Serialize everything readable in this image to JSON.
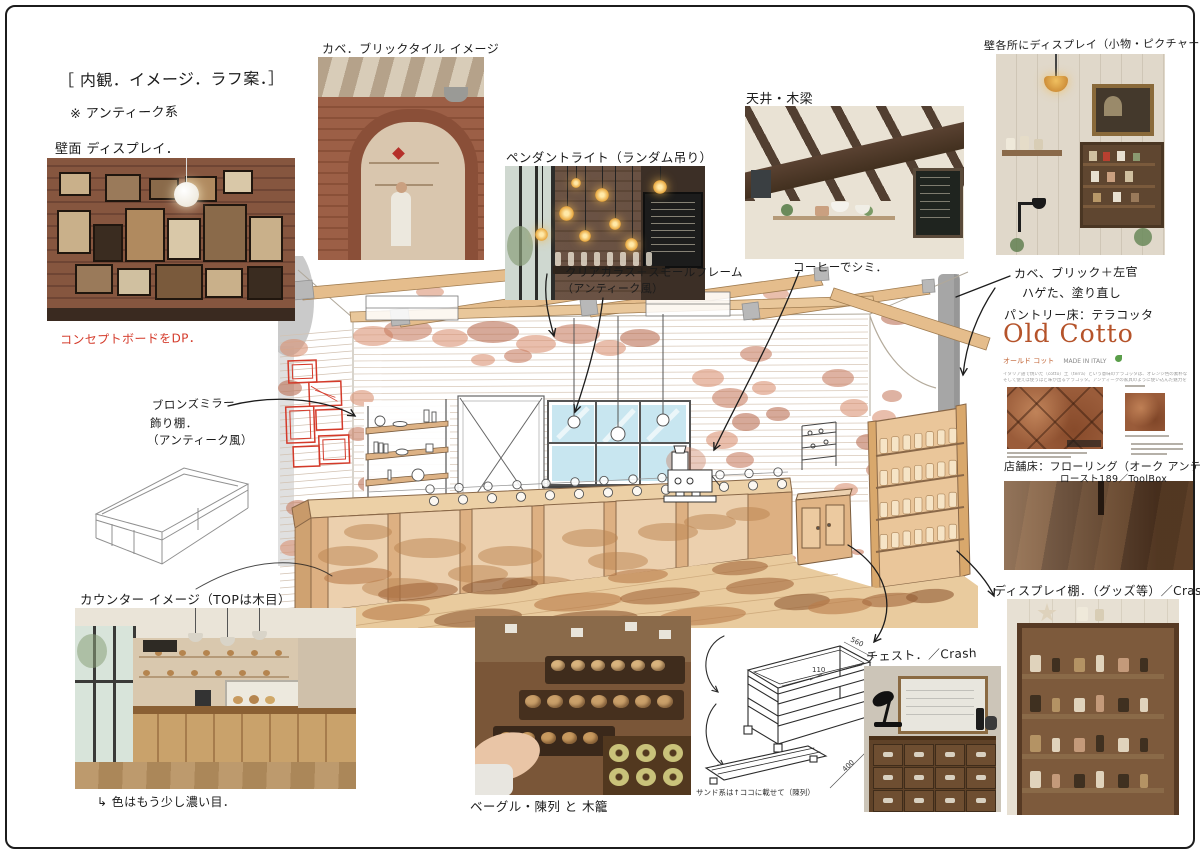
{
  "board": {
    "title": "［ 内観．イメージ．ラフ案．］",
    "subtitle": "※ アンティーク系",
    "concept_note": "コンセプトボードをDP．"
  },
  "annotations": {
    "wall_display": "壁面 ディスプレイ．",
    "brick_tile": "カベ．ブリックタイル イメージ",
    "pendant_light": "ペンダントライト（ランダム吊り）",
    "ceiling_beams": "天井・木梁",
    "wall_goods": "壁各所にディスプレイ（小物・ピクチャー‥）",
    "clear_glass_1": "クリアガラス＋スモールフレーム",
    "clear_glass_2": "（アンティーク風）",
    "coffee_stain": "コーヒーでシミ．",
    "wall_plaster_1": "カベ、ブリック＋左官",
    "wall_plaster_2": "ハゲた、塗り直し",
    "pantry_floor": "パントリー床：テラコッタ",
    "shop_floor_1": "店舗床：フローリング（オーク アンティーク）",
    "shop_floor_2": "ロースト189／ToolBox",
    "display_shelf": "ディスプレイ棚．（グッズ等）／Crash",
    "chest": "チェスト．／Crash",
    "counter": "カウンター イメージ（TOPは木目）",
    "counter_note": "↳ 色はもう少し濃い目．",
    "bagel_display": "ベーグル・陳列 と 木籠",
    "bronze_mirror_1": "ブロンズミラー",
    "bronze_mirror_2": "飾り棚．",
    "bronze_mirror_3": "（アンティーク風）",
    "crate_note": "サンド系は↑ココに載せて（陳列）"
  },
  "old_cotto": {
    "title": "Old Cotto",
    "subtitle": "オールド コット",
    "origin": "MADE IN ITALY",
    "desc_line1": "イタリア語で焼いた（cotto）土（terra）という意味のテラコッタは、オレンジ色の素朴な風合い",
    "desc_line2": "そして使えば使うほど味が出るテラコッタ。アンティークの家具のように使い込んだ魅力を増す"
  },
  "crate_dimensions": {
    "width": "560",
    "rail": "110",
    "height": "150",
    "depth": "400"
  },
  "colors": {
    "accent_red": "#d43a2a",
    "wood_tan": "#dcae7c",
    "brick_salmon": "#d98f70",
    "old_cotto_orange": "#b5532a"
  }
}
